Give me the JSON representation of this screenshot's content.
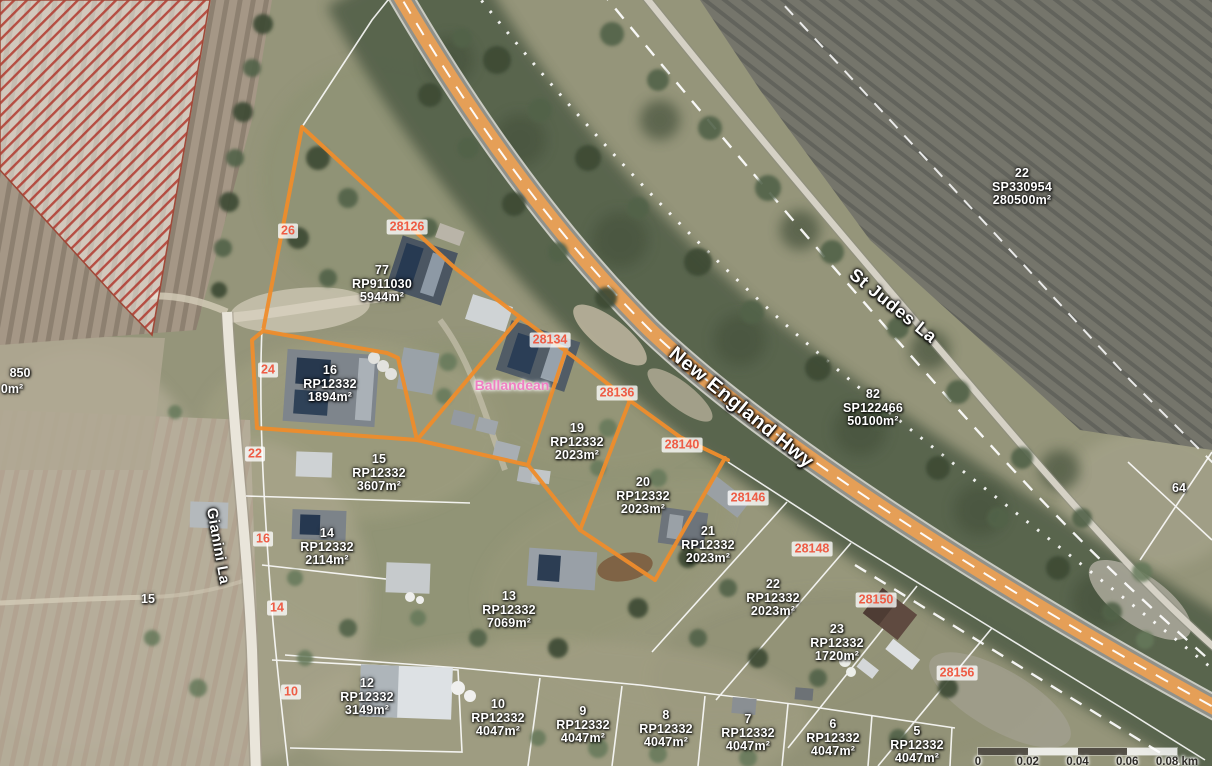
{
  "map": {
    "colors": {
      "parcel_highlight": "#ef8d2c",
      "highway_fill": "#f0a050",
      "ref_label_text": "#ee5c45",
      "place_label_pink": "#f07fc3"
    },
    "road_labels": [
      {
        "text": "New England Hwy",
        "x": 741,
        "y": 408,
        "angle": 39,
        "size": 20
      },
      {
        "text": "St Judes La",
        "x": 893,
        "y": 306,
        "angle": 39,
        "size": 18
      },
      {
        "text": "Gianini La",
        "x": 218,
        "y": 546,
        "angle": 80,
        "size": 15
      }
    ],
    "place_labels": [
      {
        "text": "Ballandean",
        "x": 512,
        "y": 385
      }
    ],
    "parcel_labels": [
      {
        "lot": "22",
        "plan": "SP330954",
        "area": "280500m²",
        "x": 1022,
        "y": 187
      },
      {
        "lot": "82",
        "plan": "SP122466",
        "area": "50100m²",
        "x": 873,
        "y": 408
      },
      {
        "lot": "77",
        "plan": "RP911030",
        "area": "5944m²",
        "x": 382,
        "y": 284
      },
      {
        "lot": "16",
        "plan": "RP12332",
        "area": "1894m²",
        "x": 330,
        "y": 384
      },
      {
        "lot": "19",
        "plan": "RP12332",
        "area": "2023m²",
        "x": 577,
        "y": 442
      },
      {
        "lot": "20",
        "plan": "RP12332",
        "area": "2023m²",
        "x": 643,
        "y": 496
      },
      {
        "lot": "21",
        "plan": "RP12332",
        "area": "2023m²",
        "x": 708,
        "y": 545
      },
      {
        "lot": "22",
        "plan": "RP12332",
        "area": "2023m²",
        "x": 773,
        "y": 598
      },
      {
        "lot": "23",
        "plan": "RP12332",
        "area": "1720m²",
        "x": 837,
        "y": 643
      },
      {
        "lot": "15",
        "plan": "RP12332",
        "area": "3607m²",
        "x": 379,
        "y": 473
      },
      {
        "lot": "14",
        "plan": "RP12332",
        "area": "2114m²",
        "x": 327,
        "y": 547
      },
      {
        "lot": "13",
        "plan": "RP12332",
        "area": "7069m²",
        "x": 509,
        "y": 610
      },
      {
        "lot": "12",
        "plan": "RP12332",
        "area": "3149m²",
        "x": 367,
        "y": 697
      },
      {
        "lot": "10",
        "plan": "RP12332",
        "area": "4047m²",
        "x": 498,
        "y": 718
      },
      {
        "lot": "9",
        "plan": "RP12332",
        "area": "4047m²",
        "x": 583,
        "y": 725
      },
      {
        "lot": "8",
        "plan": "RP12332",
        "area": "4047m²",
        "x": 666,
        "y": 729
      },
      {
        "lot": "7",
        "plan": "RP12332",
        "area": "4047m²",
        "x": 748,
        "y": 733
      },
      {
        "lot": "6",
        "plan": "RP12332",
        "area": "4047m²",
        "x": 833,
        "y": 738
      },
      {
        "lot": "5",
        "plan": "RP12332",
        "area": "4047m²",
        "x": 917,
        "y": 745
      }
    ],
    "ref_labels": [
      {
        "text": "26",
        "x": 288,
        "y": 231
      },
      {
        "text": "28126",
        "x": 407,
        "y": 227
      },
      {
        "text": "24",
        "x": 268,
        "y": 370
      },
      {
        "text": "28134",
        "x": 550,
        "y": 340
      },
      {
        "text": "28136",
        "x": 617,
        "y": 393
      },
      {
        "text": "28140",
        "x": 682,
        "y": 445
      },
      {
        "text": "28146",
        "x": 748,
        "y": 498
      },
      {
        "text": "28148",
        "x": 812,
        "y": 549
      },
      {
        "text": "28150",
        "x": 876,
        "y": 600
      },
      {
        "text": "28156",
        "x": 957,
        "y": 673
      },
      {
        "text": "22",
        "x": 255,
        "y": 454
      },
      {
        "text": "16",
        "x": 263,
        "y": 539
      },
      {
        "text": "14",
        "x": 277,
        "y": 608
      },
      {
        "text": "10",
        "x": 291,
        "y": 692
      }
    ],
    "small_labels": [
      {
        "text": "15",
        "x": 148,
        "y": 599
      },
      {
        "text": "64",
        "x": 1179,
        "y": 488
      },
      {
        "text": "850",
        "x": 20,
        "y": 373
      },
      {
        "text": "0m²",
        "x": 12,
        "y": 389
      }
    ],
    "scalebar": {
      "segment_colors": [
        "dark",
        "light",
        "dark",
        "light"
      ],
      "ticks": [
        {
          "label": "0",
          "pos": 0
        },
        {
          "label": "0.02",
          "pos": 25
        },
        {
          "label": "0.04",
          "pos": 50
        },
        {
          "label": "0.06",
          "pos": 75
        },
        {
          "label": "0.08 km",
          "pos": 100
        }
      ]
    }
  }
}
